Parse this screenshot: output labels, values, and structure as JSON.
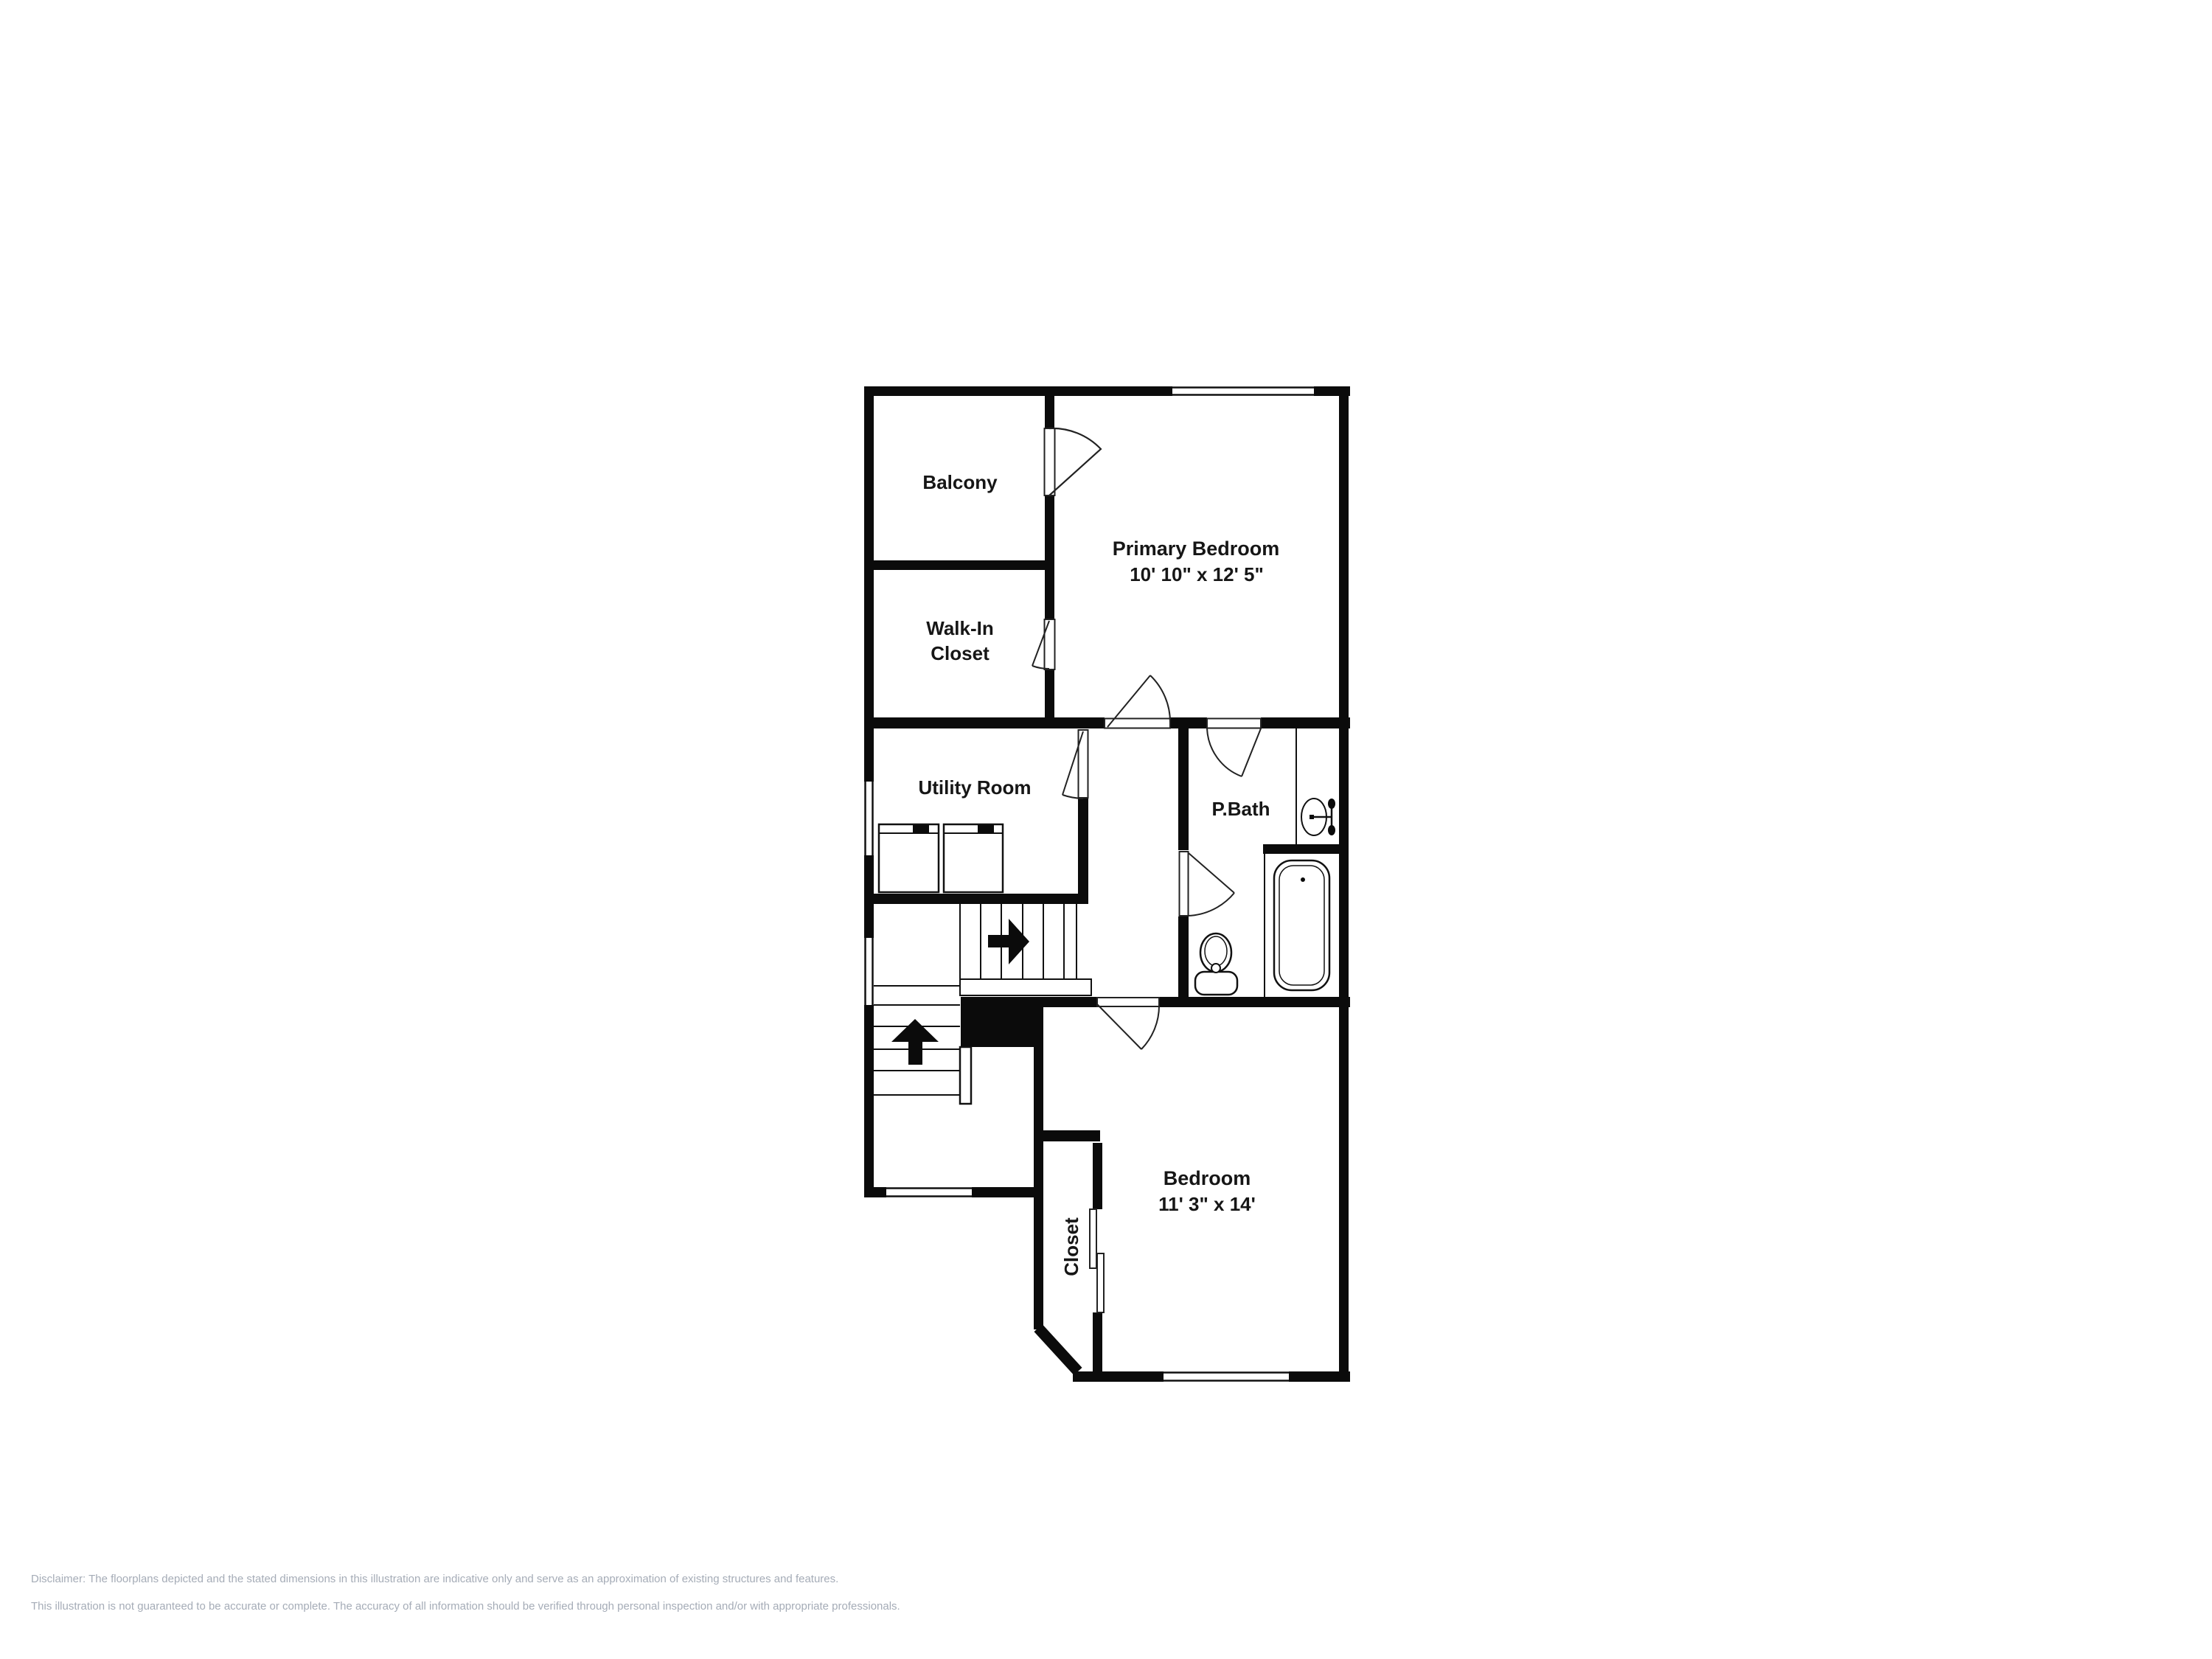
{
  "floorplan": {
    "wall_color": "#0b0b0b",
    "line_color": "#111111",
    "label_color": "#161616",
    "rooms": {
      "balcony": {
        "label": "Balcony"
      },
      "primary_bedroom": {
        "label": "Primary Bedroom",
        "dimensions": "10' 10\" x 12' 5\""
      },
      "walk_in_closet": {
        "label_line1": "Walk-In",
        "label_line2": "Closet"
      },
      "utility_room": {
        "label": "Utility Room"
      },
      "primary_bath": {
        "label": "P.Bath"
      },
      "bedroom": {
        "label": "Bedroom",
        "dimensions": "11' 3\" x 14'"
      },
      "closet": {
        "label": "Closet"
      }
    },
    "fixtures": {
      "washer": "washer",
      "dryer": "dryer",
      "sink": "sink",
      "toilet": "toilet",
      "bathtub": "bathtub"
    },
    "stairs": {
      "upper_flight_direction": "right",
      "lower_flight_direction": "up"
    }
  },
  "disclaimer": {
    "line1": "Disclaimer: The floorplans depicted and the stated dimensions in this illustration are indicative only and serve as an approximation of existing structures and features.",
    "line2": "This illustration is not guaranteed to be accurate or complete. The accuracy of all information should be verified through personal inspection and/or with appropriate professionals.",
    "color": "#a5acb7"
  }
}
